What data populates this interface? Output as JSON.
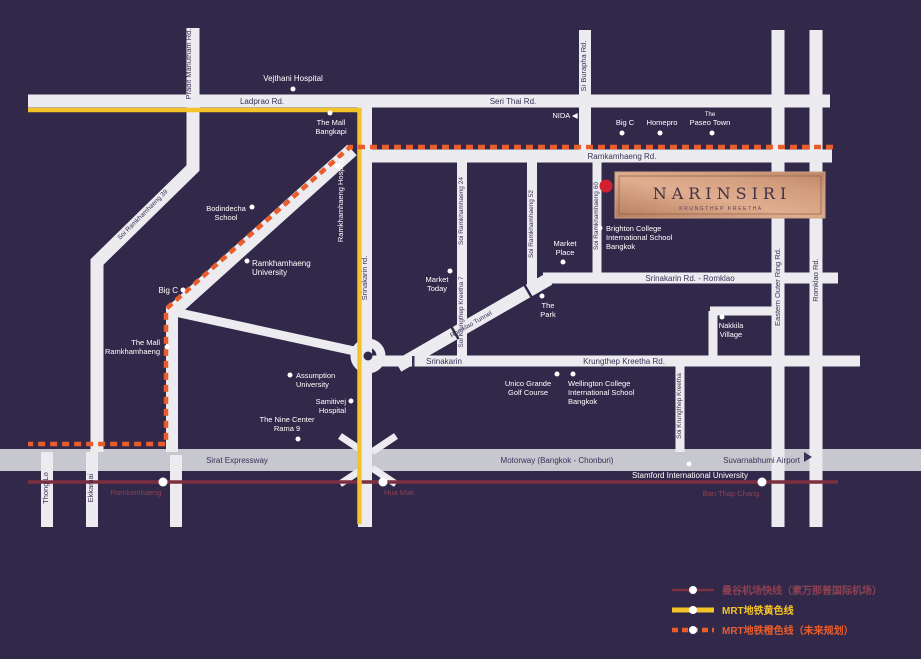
{
  "colors": {
    "background": "#32294a",
    "road": "#ececf0",
    "expressway": "#c7c7d0",
    "road_text": "#3b3156",
    "white_text": "#ffffff",
    "mrt_yellow": "#f3c329",
    "mrt_orange": "#e85d2b",
    "airport_link": "#7c2f3f",
    "station_text": "#8d4152",
    "project_dot": "#d2202e",
    "logo_copper": "#d9a98c"
  },
  "project": {
    "name": "NARINSIRI",
    "subtitle": "KRUNGTHEP KREETHA"
  },
  "roads": {
    "ladprao": "Ladprao Rd.",
    "seri_thai": "Seri Thai Rd.",
    "ramkamhaeng": "Ramkamhaeng Rd.",
    "pradit_manutham": "Pradit Manutham Rd.",
    "si_burapha": "Si Burapha Rd.",
    "srinakarin_vertical": "Srinakarin rd.",
    "srinakarin_romklao": "Srinakarin Rd. - Romklao",
    "krungthep_kreetha": "Krungthep Kreetha Rd.",
    "srinakarin_west": "Srinakarin",
    "eastern_outer_ring": "Eastern Outer Ring Rd.",
    "romklao": "Romklao Rd.",
    "sirat_expressway": "Sirat Expressway",
    "motorway": "Motorway (Bangkok - Chonburi)",
    "suvarnabhumi_airport": "Suvarnabhumi Airport",
    "thong_lo": "Thong Lo",
    "ekkamai": "Ekkamai",
    "soi_ramkhamhaeng_39": "Soi Ramkhamhaeng 39",
    "soi_ramkhamhaeng_24": "Soi Ramkhamhaeng 24",
    "soi_krungthep_kreetha_7": "Soi Krungthep Kreetha 7",
    "soi_ramkhamhaeng_52": "Soi Ramkhamhaeng 52",
    "soi_ramkhamhaeng_60": "Soi Ramkhamhaeng 60",
    "soi_krungthep_kreetha": "Soi Krungthep Kreetha",
    "romklao_tunnel": "Romklao Tunnel"
  },
  "places": {
    "vejthani": "Vejthani Hospital",
    "the_mall_bangkapi": [
      "The Mall",
      "Bangkapi"
    ],
    "nida": "NIDA ◀",
    "big_c_east": "Big C",
    "homepro": "Homepro",
    "the_paseo_town": [
      "The",
      "Paseo Town"
    ],
    "bodindecha": [
      "Bodindecha",
      "School"
    ],
    "ramkhamhaeng_hospital": "Ramkhamhaeng Hospital",
    "ramkhamhaeng_university": [
      "Ramkhamhaeng",
      "University"
    ],
    "big_c_west": "Big C",
    "the_mall_ramkhamhaeng": [
      "The Mall",
      "Ramkhamhaeng"
    ],
    "brighton_college": [
      "Brighton College",
      "International School",
      "Bangkok"
    ],
    "market_place": [
      "Market",
      "Place"
    ],
    "market_today": [
      "Market",
      "Today"
    ],
    "the_park": [
      "The",
      "Park"
    ],
    "nakkila_village": [
      "Nakkila",
      "Village"
    ],
    "assumption_university": [
      "Assumption",
      "University"
    ],
    "samitivej_hospital": [
      "Samitivej",
      "Hospital"
    ],
    "the_nine_center": [
      "The Nine Center",
      "Rama 9"
    ],
    "unico_grande": [
      "Unico Grande",
      "Golf Course"
    ],
    "wellington_college": [
      "Wellington College",
      "International School",
      "Bangkok"
    ],
    "stamford_university": "Stamford International University"
  },
  "stations": {
    "ramkamhaeng": "Ramkamhaeng",
    "hua_mak": "Hua Mak",
    "ban_thap_chang": "Ban Thap Chang"
  },
  "legend": {
    "airport_link": "曼谷机场快线（素万那普国际机场）",
    "yellow_line": "MRT地铁黄色线",
    "orange_line": "MRT地铁橙色线（未来规划）"
  }
}
